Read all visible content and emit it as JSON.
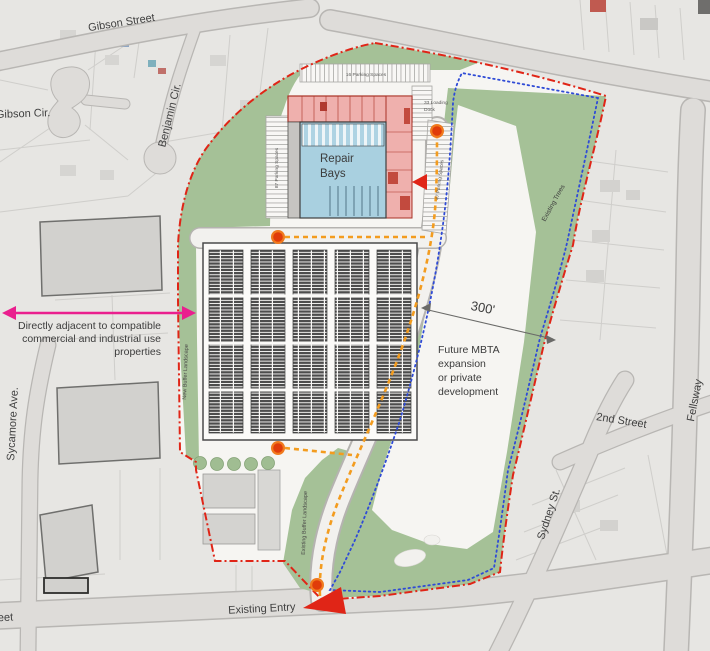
{
  "streets": {
    "gibson_street": "Gibson Street",
    "gibson_cir": "Gibson Cir.",
    "benjamin_cir": "Benjamin Cir.",
    "sycamore_ave": "Sycamore Ave.",
    "second_street": "2nd Street",
    "sydney_st": "Sydney St.",
    "fellsway": "Fellsway",
    "street_partial": "Street",
    "existing_entry": "Existing Entry"
  },
  "site": {
    "repair_bays_line1": "Repair",
    "repair_bays_line2": "Bays",
    "parking_top": "16 Parking Spaces",
    "parking_left": "87 Parking Spaces",
    "parking_right": "47 Parking Spaces",
    "loading_line1": "33 Loading",
    "loading_line2": "Dock",
    "new_buffer": "New Buffer Landscape",
    "existing_buffer": "Existing Buffer Landscape",
    "existing_trees": "Existing Trees"
  },
  "annotations": {
    "adjacent_line1": "Directly adjacent to compatible",
    "adjacent_line2": "commercial and industrial use",
    "adjacent_line3": "properties",
    "mbta_line1": "Future MBTA",
    "mbta_line2": "expansion",
    "mbta_line3": "or private",
    "mbta_line4": "development",
    "distance": "300'"
  },
  "colors": {
    "site_boundary_red": "#e02517",
    "easement_blue": "#2f4bd6",
    "bus_route_orange": "#f39c1f",
    "route_stop_dot": "#e8440e",
    "annotation_magenta": "#ea1f8e",
    "building_pink": "#efb0ad",
    "repair_bays_blue": "#a9d0e0",
    "landscape_green": "#a5c197"
  }
}
